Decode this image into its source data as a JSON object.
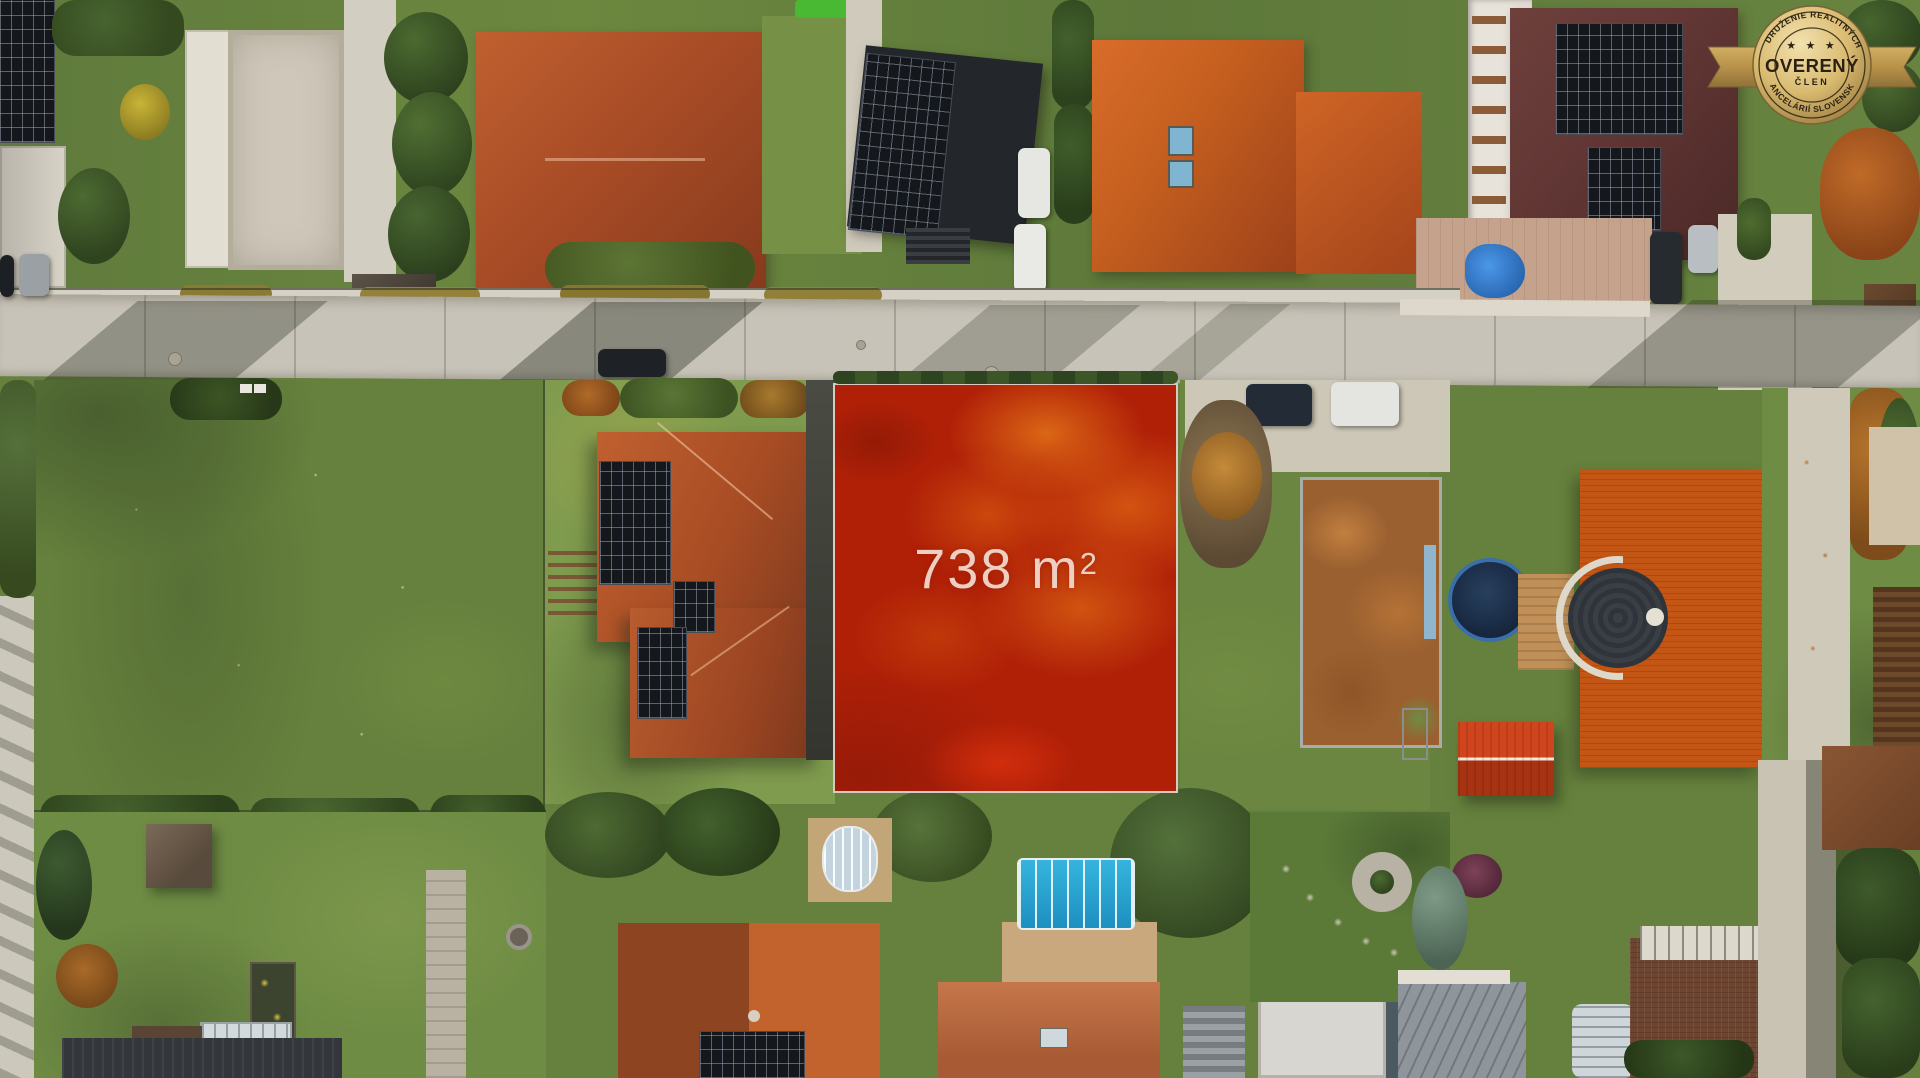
{
  "overlay": {
    "area_value": "738",
    "area_unit": "m",
    "area_exponent": "2",
    "plot_fill_color": "#b02007",
    "plot_border_color": "#e1e7e0",
    "label_color": "#f3ddd1"
  },
  "badge": {
    "arc_top": "ZDRUŽENIE REALITNÝCH",
    "title": "OVERENÝ",
    "subtitle": "ČLEN",
    "arc_bottom": "KANCELÁRIÍ SLOVENSKA",
    "stars": "★ ★ ★",
    "gold_light": "#f2e2ae",
    "gold_mid": "#d9ba70",
    "gold_dark": "#9d7e42",
    "ribbon_gold": "#c3a054",
    "text_color": "#2b2112"
  },
  "palette": {
    "road": "#c8c3b8",
    "sidewalk": "#d6d1c5",
    "meadow_green": "#66813d",
    "lawn_green": "#6f8c44",
    "terracotta_roof": "#b0512b",
    "orange_roof": "#c55f1f",
    "maroon_roof": "#5f3533",
    "dark_solar_roof": "#14171c",
    "pool_blue": "#2aa9d6",
    "tarp_blue": "#2f7fd6"
  }
}
